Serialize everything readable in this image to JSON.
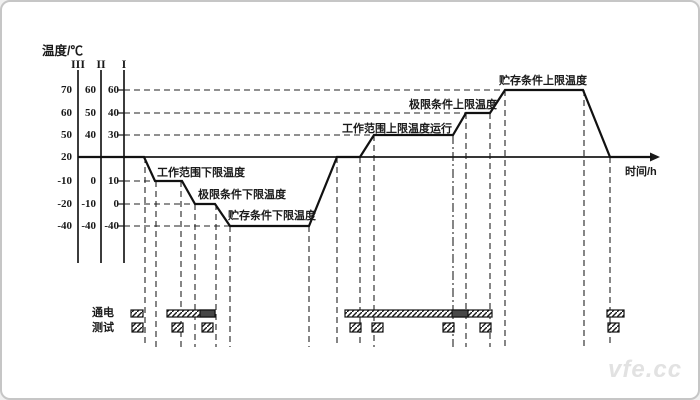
{
  "watermark": "vfe.cc",
  "axes": {
    "y_title": "温度/℃",
    "x_title": "时间/h",
    "headers": [
      "III",
      "II",
      "I"
    ],
    "scales": {
      "c3": [
        "70",
        "60",
        "50",
        "20",
        "-10",
        "-20",
        "-40"
      ],
      "c2": [
        "60",
        "50",
        "40",
        "",
        "0",
        "-10",
        "-40"
      ],
      "c1": [
        "60",
        "40",
        "30",
        "",
        "10",
        "0",
        "-40"
      ]
    }
  },
  "labels": {
    "work_lower": "工作范围下限温度",
    "limit_lower": "极限条件下限温度",
    "storage_lower": "贮存条件下限温度",
    "work_upper": "工作范围上限温度运行",
    "limit_upper": "极限条件上限温度",
    "storage_upper": "贮存条件上限温度"
  },
  "timeline": {
    "power": "通电",
    "test": "测试"
  },
  "chart_data": {
    "type": "line",
    "xlabel": "时间/h",
    "ylabel": "温度/℃",
    "x_numeric": false,
    "ambient_level": 20,
    "gridline_levels": [
      60,
      40,
      30,
      10,
      0,
      -40
    ],
    "profile_sequence": [
      20,
      10,
      0,
      -40,
      20,
      30,
      40,
      60,
      20
    ],
    "severity_scales": [
      {
        "name": "III",
        "levels": [
          70,
          60,
          50,
          20,
          -10,
          -20,
          -40
        ]
      },
      {
        "name": "II",
        "levels": [
          60,
          50,
          40,
          null,
          0,
          -10,
          -40
        ]
      },
      {
        "name": "I",
        "levels": [
          60,
          40,
          30,
          null,
          10,
          0,
          -40
        ]
      }
    ],
    "annotations": [
      "贮存条件上限温度",
      "极限条件上限温度",
      "工作范围上限温度运行",
      "工作范围下限温度",
      "极限条件下限温度",
      "贮存条件下限温度"
    ],
    "legend_position": "none",
    "grid": "dashed"
  }
}
